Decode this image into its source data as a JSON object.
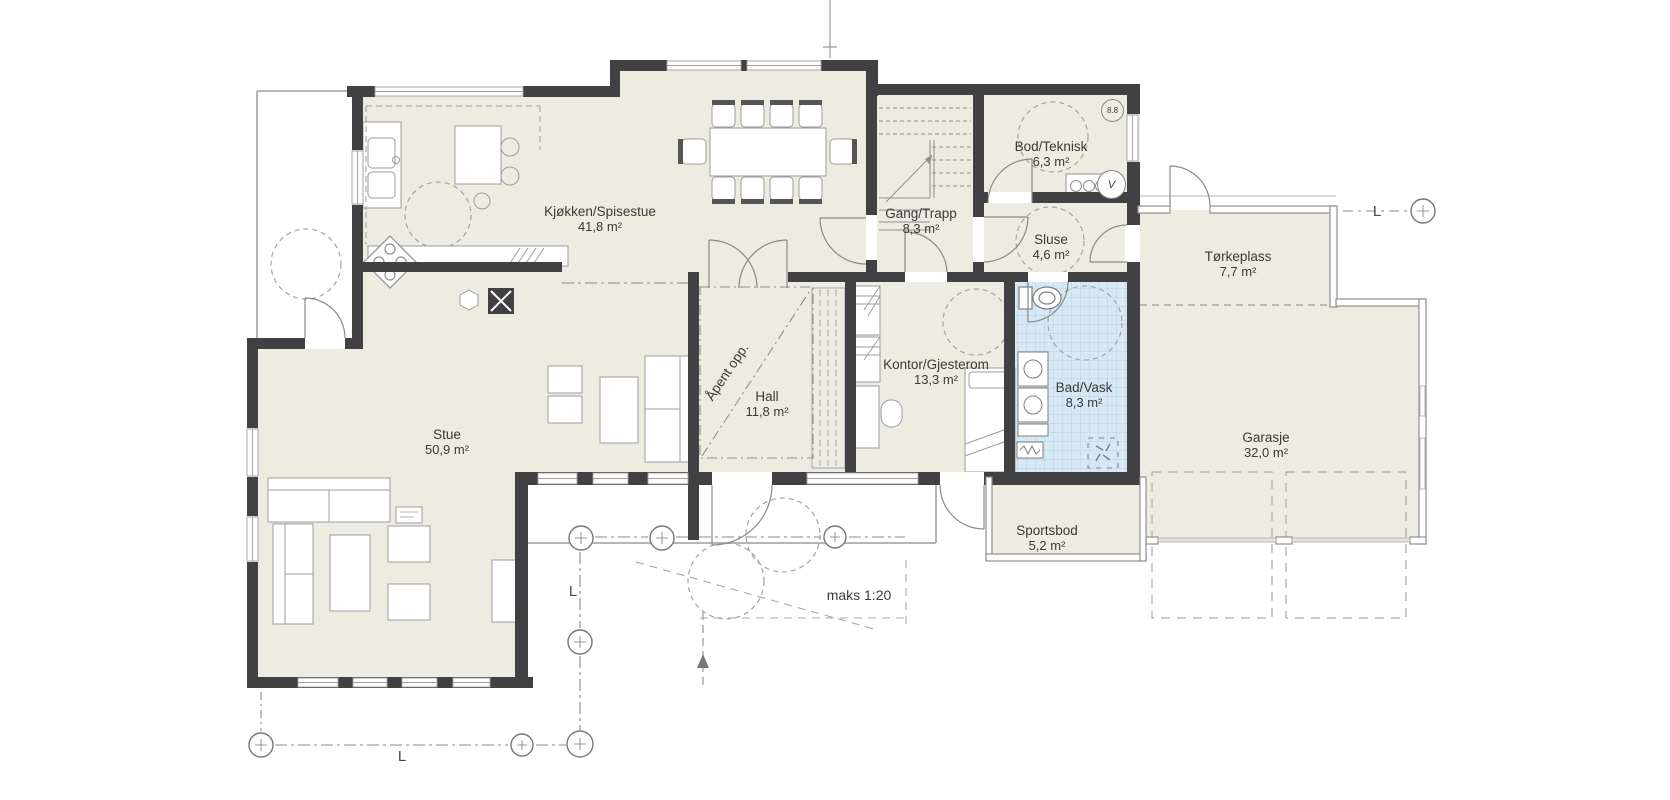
{
  "plan": {
    "rooms": [
      {
        "name": "Kjøkken/Spisestue",
        "area": "41,8 m²"
      },
      {
        "name": "Gang/Trapp",
        "area": "8,3 m²"
      },
      {
        "name": "Bod/Teknisk",
        "area": "6,3 m²"
      },
      {
        "name": "Sluse",
        "area": "4,6 m²"
      },
      {
        "name": "Tørkeplass",
        "area": "7,7 m²"
      },
      {
        "name": "Hall",
        "area": "11,8 m²"
      },
      {
        "name": "Kontor/Gjesterom",
        "area": "13,3 m²"
      },
      {
        "name": "Bad/Vask",
        "area": "8,3 m²"
      },
      {
        "name": "Garasje",
        "area": "32,0 m²"
      },
      {
        "name": "Stue",
        "area": "50,9 m²"
      },
      {
        "name": "Sportsbod",
        "area": "5,2 m²"
      }
    ],
    "annotations": {
      "open_above": "Åpent opp.",
      "ramp_max_slope": "maks 1:20",
      "grid_letter": "L",
      "reference_bubble": "8.8",
      "water_heater": "V"
    },
    "colors": {
      "wall": "#414143",
      "floor": "#eeebe1",
      "bathroom_floor": "#d6e9f4",
      "line": "#8f8f8f",
      "background": "#ffffff"
    }
  }
}
